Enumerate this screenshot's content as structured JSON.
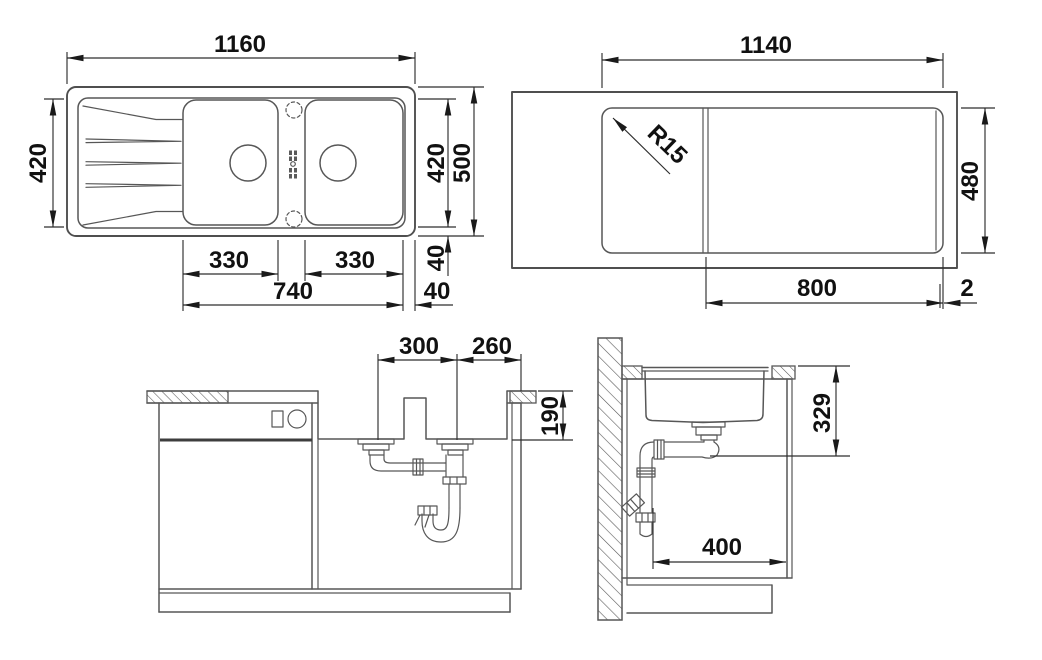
{
  "drawing_type": "sink installation technical drawing",
  "colors": {
    "background": "#ffffff",
    "line": "#575757",
    "dimension_line": "#2e2e2e",
    "text": "#111111"
  },
  "plan": {
    "width": "1160",
    "depth_left": "420",
    "depth_right": "420",
    "depth_total": "500",
    "bowl_left_width": "330",
    "bowl_right_width": "330",
    "bowls_span": "740",
    "margin_bottom": "40",
    "margin_side": "40"
  },
  "cutout": {
    "width": "1140",
    "depth": "480",
    "corner_radius": "R15",
    "offset_right": "800",
    "edge_gap": "2"
  },
  "front": {
    "drain_spacing": "300",
    "drain_to_edge": "260",
    "bowl_depth": "190"
  },
  "side": {
    "outlet_height": "329",
    "clearance_depth": "400"
  }
}
